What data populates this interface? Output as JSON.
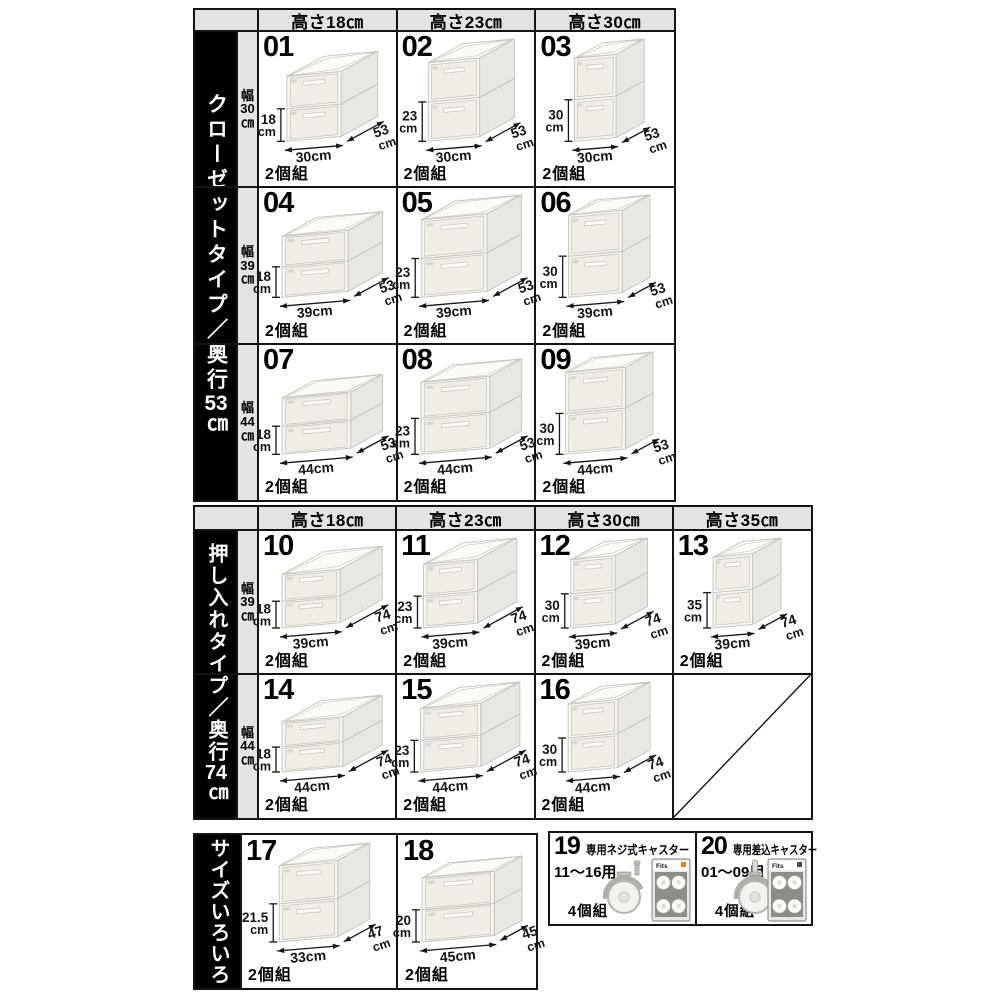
{
  "colors": {
    "page_bg": "#ffffff",
    "border": "#141414",
    "header_bg": "#e3e3e3",
    "row_label_bg": "#e3e3e3",
    "banner_bg": "#000000",
    "banner_text": "#ffffff",
    "box_front": "#f6f5f1",
    "box_front_inner": "#f0ede7",
    "box_side": "#e9e7e1",
    "box_top": "#fafaf6",
    "box_edge": "#c6c3bc",
    "accent_orange": "#e0831f"
  },
  "dim_unit": "cm",
  "tables": [
    {
      "banner": "クローゼットタイプ／奥行53㎝",
      "headers": [
        "高さ18㎝",
        "高さ23㎝",
        "高さ30㎝"
      ],
      "rows": [
        {
          "label_lines": [
            "幅",
            "30",
            "㎝"
          ],
          "cells": [
            {
              "num": "01",
              "h": "18",
              "w": "30",
              "d": "53",
              "set": "2個組"
            },
            {
              "num": "02",
              "h": "23",
              "w": "30",
              "d": "53",
              "set": "2個組"
            },
            {
              "num": "03",
              "h": "30",
              "w": "30",
              "d": "53",
              "set": "2個組"
            }
          ]
        },
        {
          "label_lines": [
            "幅",
            "39",
            "㎝"
          ],
          "cells": [
            {
              "num": "04",
              "h": "18",
              "w": "39",
              "d": "53",
              "set": "2個組"
            },
            {
              "num": "05",
              "h": "23",
              "w": "39",
              "d": "53",
              "set": "2個組"
            },
            {
              "num": "06",
              "h": "30",
              "w": "39",
              "d": "53",
              "set": "2個組"
            }
          ]
        },
        {
          "label_lines": [
            "幅",
            "44",
            "㎝"
          ],
          "cells": [
            {
              "num": "07",
              "h": "18",
              "w": "44",
              "d": "53",
              "set": "2個組"
            },
            {
              "num": "08",
              "h": "23",
              "w": "44",
              "d": "53",
              "set": "2個組"
            },
            {
              "num": "09",
              "h": "30",
              "w": "44",
              "d": "53",
              "set": "2個組"
            }
          ]
        }
      ]
    },
    {
      "banner": "押し入れタイプ／奥行74㎝",
      "headers": [
        "高さ18㎝",
        "高さ23㎝",
        "高さ30㎝",
        "高さ35㎝"
      ],
      "rows": [
        {
          "label_lines": [
            "幅",
            "39",
            "㎝"
          ],
          "cells": [
            {
              "num": "10",
              "h": "18",
              "w": "39",
              "d": "74",
              "set": "2個組"
            },
            {
              "num": "11",
              "h": "23",
              "w": "39",
              "d": "74",
              "set": "2個組"
            },
            {
              "num": "12",
              "h": "30",
              "w": "39",
              "d": "74",
              "set": "2個組"
            },
            {
              "num": "13",
              "h": "35",
              "w": "39",
              "d": "74",
              "set": "2個組"
            }
          ]
        },
        {
          "label_lines": [
            "幅",
            "44",
            "㎝"
          ],
          "cells": [
            {
              "num": "14",
              "h": "18",
              "w": "44",
              "d": "74",
              "set": "2個組"
            },
            {
              "num": "15",
              "h": "23",
              "w": "44",
              "d": "74",
              "set": "2個組"
            },
            {
              "num": "16",
              "h": "30",
              "w": "44",
              "d": "74",
              "set": "2個組"
            },
            {
              "empty": true
            }
          ]
        }
      ]
    },
    {
      "banner": "サイズいろいろ",
      "cells": [
        {
          "num": "17",
          "h": "21.5",
          "w": "33",
          "d": "47",
          "set": "2個組"
        },
        {
          "num": "18",
          "h": "20",
          "w": "45",
          "d": "45",
          "set": "2個組"
        }
      ]
    }
  ],
  "casters": {
    "cells": [
      {
        "num": "19",
        "title": "専用ネジ式キャスター",
        "for_label": "11〜16用",
        "set": "4個組",
        "brand": "Fits",
        "type": "screw"
      },
      {
        "num": "20",
        "title": "専用差込キャスター",
        "for_label": "01〜09用",
        "set": "4個組",
        "brand": "Fits",
        "type": "stem"
      }
    ]
  }
}
